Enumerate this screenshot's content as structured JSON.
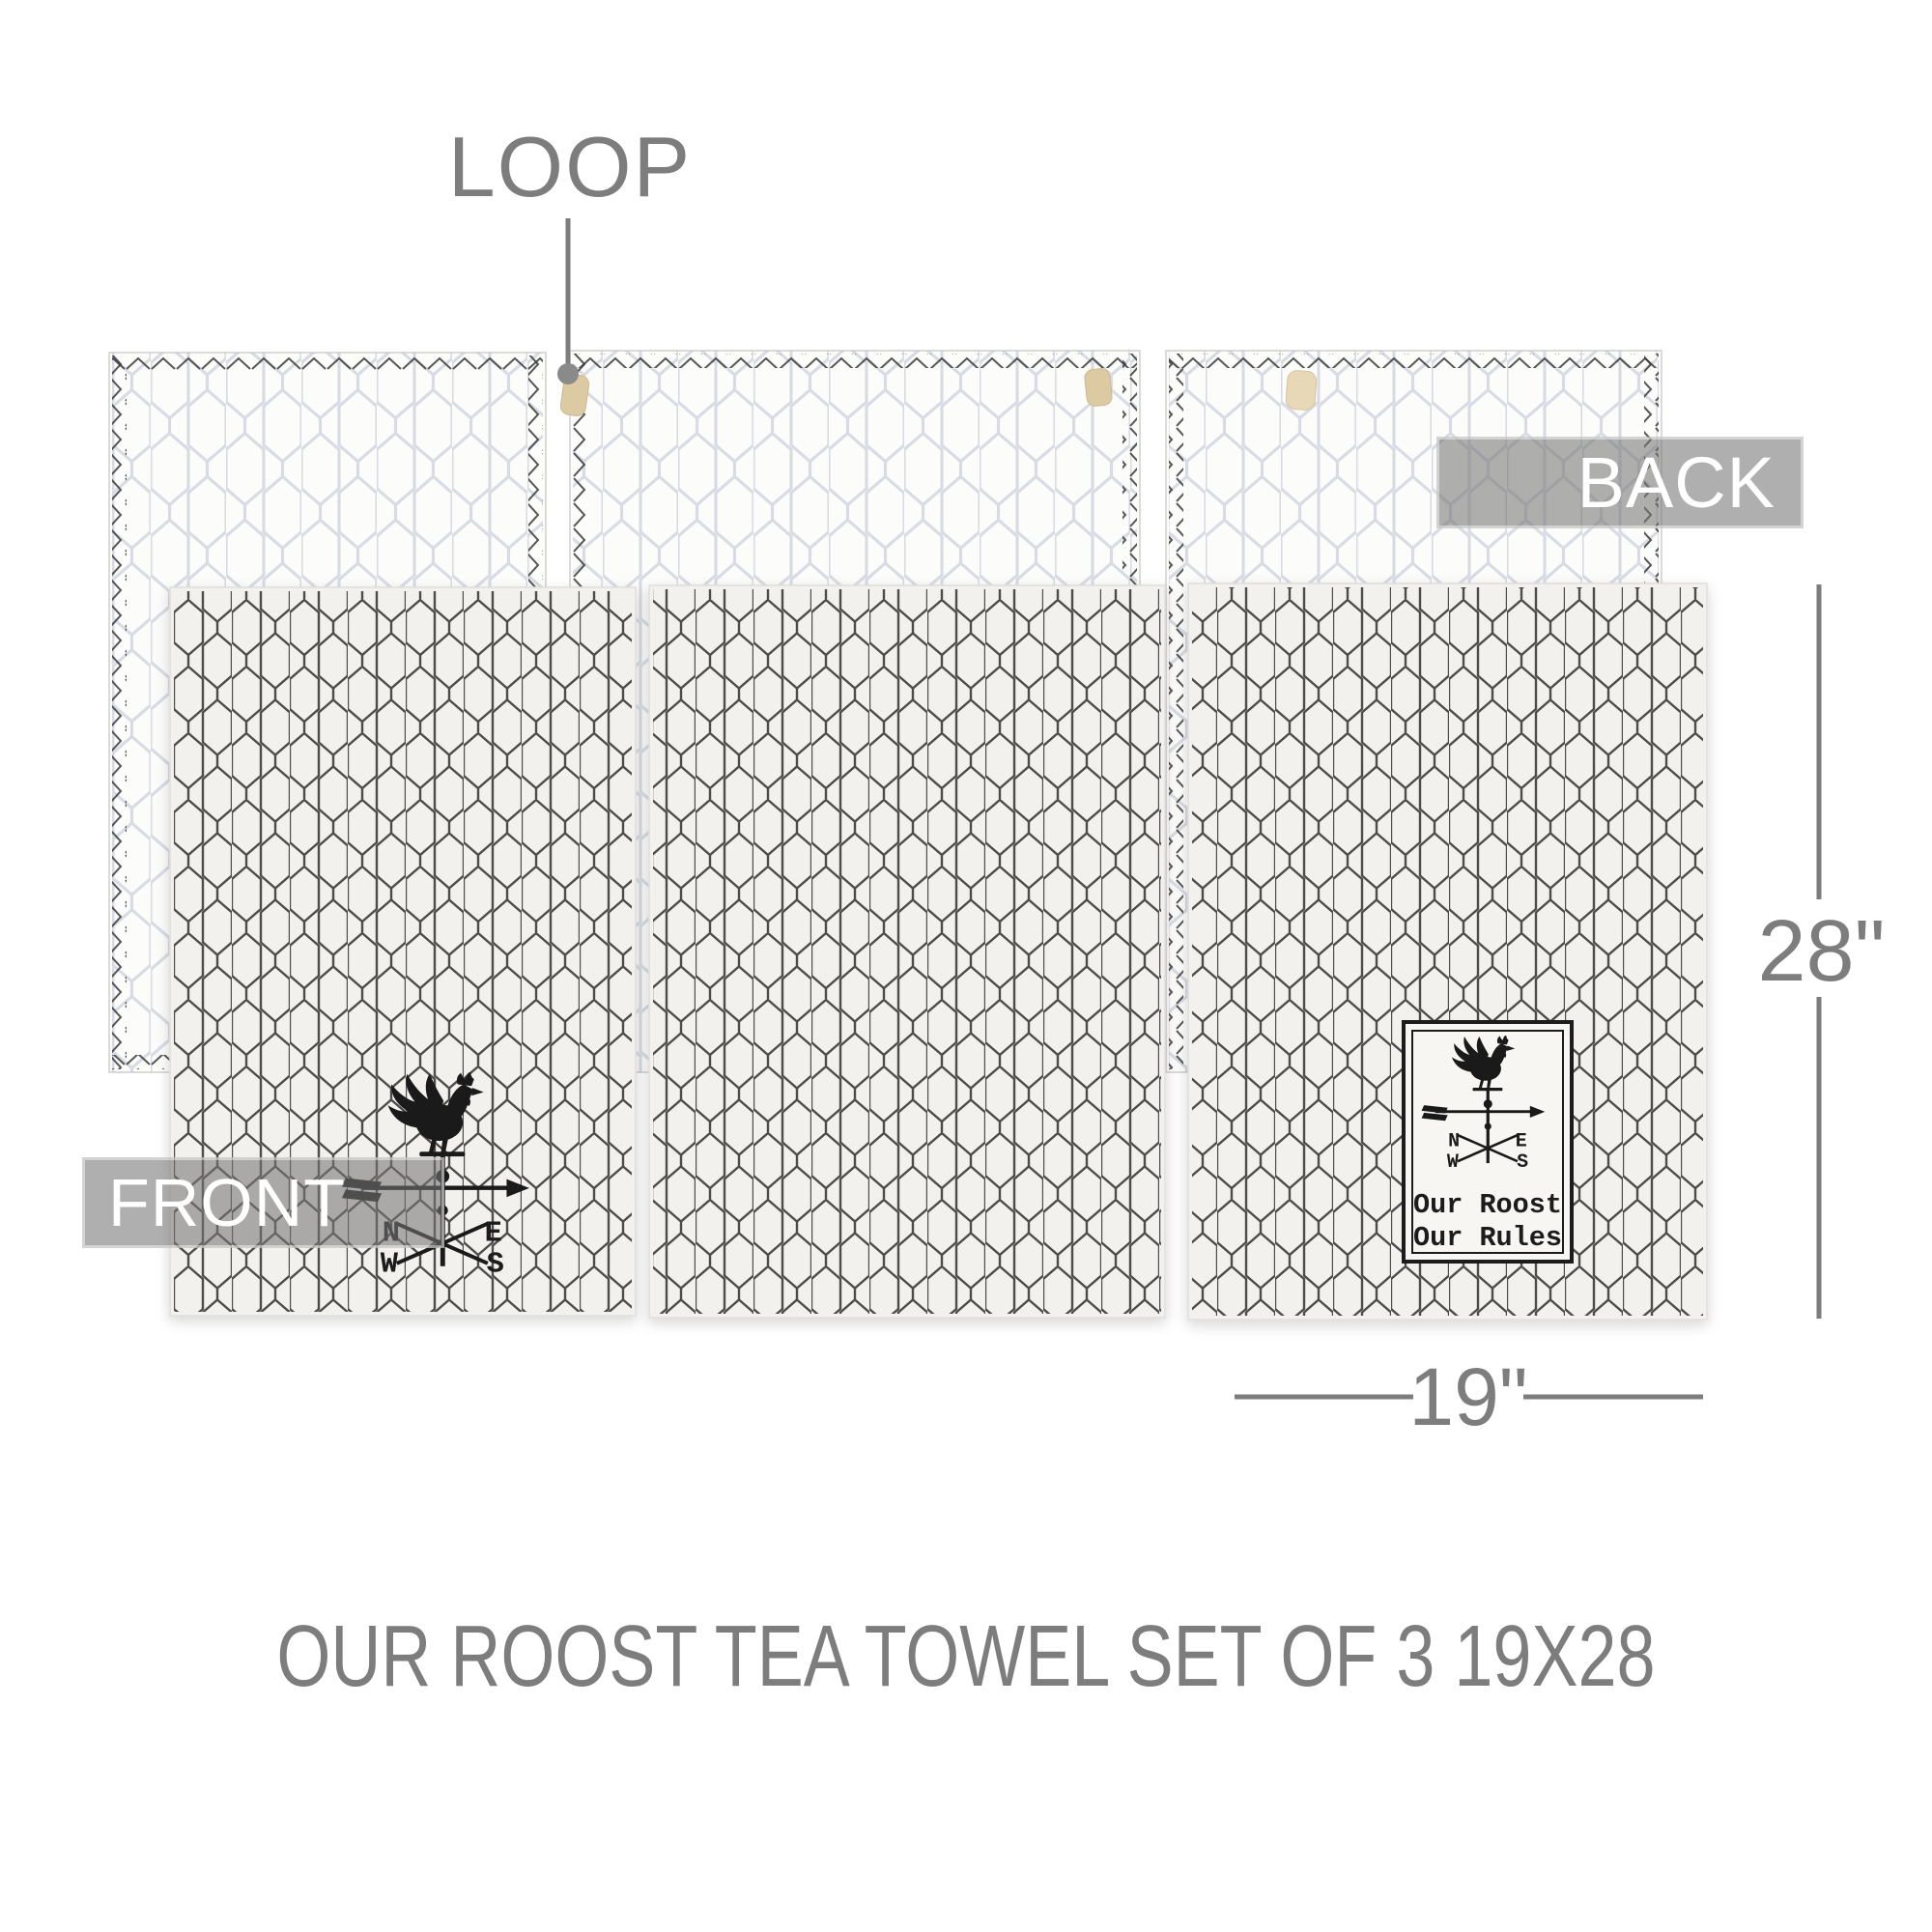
{
  "annotations": {
    "loop_label": "LOOP",
    "back_label": "BACK",
    "front_label": "FRONT",
    "height_label": "28\"",
    "width_label": "19\"",
    "caption": "OUR ROOST TEA TOWEL SET OF 3 19X28"
  },
  "stamp": {
    "line1": "Our Roost",
    "line2": "Our Rules"
  },
  "compass": {
    "n": "N",
    "e": "E",
    "w": "W",
    "s": "S"
  },
  "colors": {
    "annotation_gray": "#7d7d7d",
    "banner_text": "#ffffff",
    "pattern_dark": "#3f3e3c",
    "pattern_light": "#b9bfcf",
    "loop_tag_tan": "#dccaa2",
    "fabric_front": "#f2f1ee",
    "fabric_back": "#fcfcfb",
    "graphic_black": "#1a1a1a"
  }
}
